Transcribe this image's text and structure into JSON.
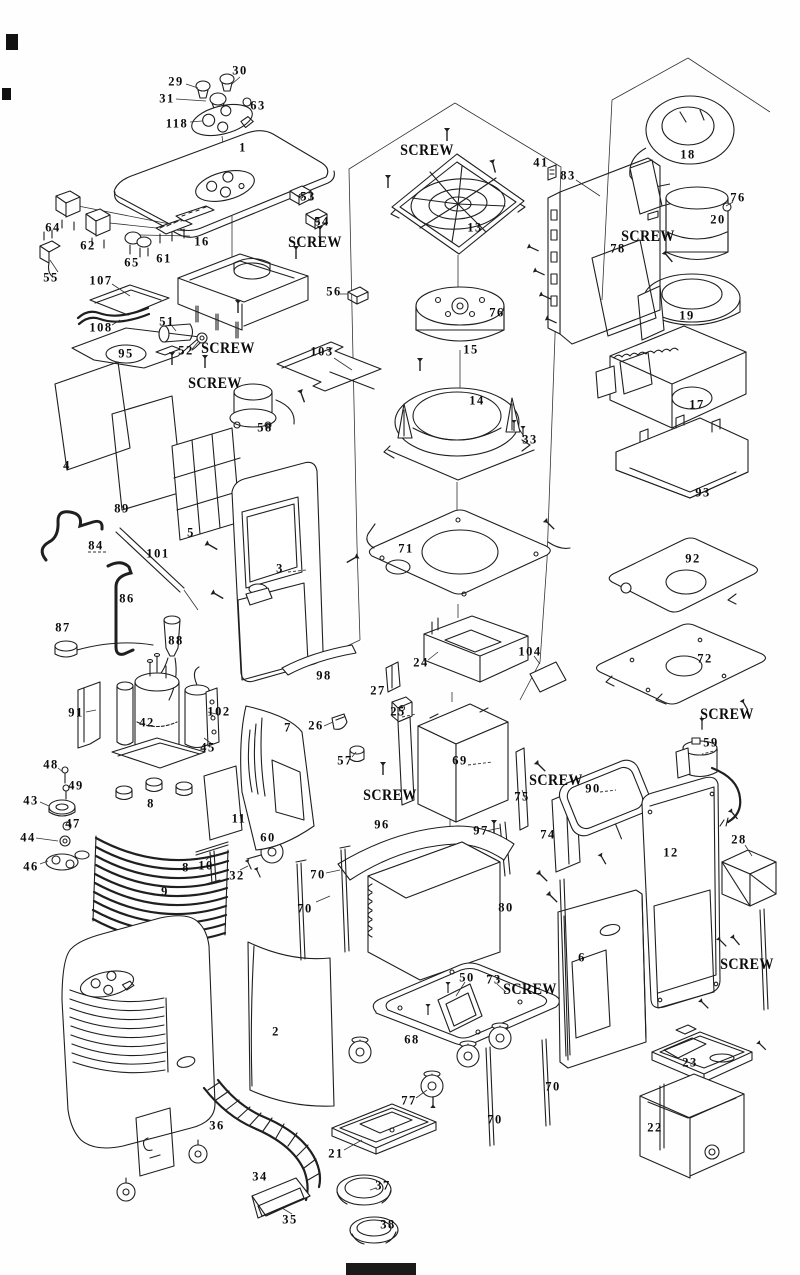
{
  "diagram": {
    "type": "exploded-parts-diagram",
    "subject": "portable air conditioner exploded parts view",
    "background_color": "#fefefe",
    "line_color": "#1f1f1f",
    "label_color": "#0d0d0d",
    "screw_text": "SCREW",
    "part_labels": [
      {
        "text": "29",
        "x": 176,
        "y": 82
      },
      {
        "text": "30",
        "x": 240,
        "y": 71
      },
      {
        "text": "31",
        "x": 167,
        "y": 99
      },
      {
        "text": "63",
        "x": 258,
        "y": 106
      },
      {
        "text": "118",
        "x": 177,
        "y": 124
      },
      {
        "text": "1",
        "x": 243,
        "y": 148
      },
      {
        "text": "53",
        "x": 308,
        "y": 197
      },
      {
        "text": "54",
        "x": 322,
        "y": 222
      },
      {
        "text": "64",
        "x": 53,
        "y": 228
      },
      {
        "text": "62",
        "x": 88,
        "y": 246
      },
      {
        "text": "65",
        "x": 132,
        "y": 263
      },
      {
        "text": "61",
        "x": 164,
        "y": 259
      },
      {
        "text": "16",
        "x": 202,
        "y": 242
      },
      {
        "text": "55",
        "x": 51,
        "y": 278
      },
      {
        "text": "107",
        "x": 101,
        "y": 281
      },
      {
        "text": "108",
        "x": 101,
        "y": 328
      },
      {
        "text": "51",
        "x": 167,
        "y": 322
      },
      {
        "text": "52",
        "x": 186,
        "y": 351
      },
      {
        "text": "95",
        "x": 126,
        "y": 354
      },
      {
        "text": "56",
        "x": 334,
        "y": 292
      },
      {
        "text": "103",
        "x": 322,
        "y": 352
      },
      {
        "text": "58",
        "x": 265,
        "y": 428
      },
      {
        "text": "4",
        "x": 67,
        "y": 466
      },
      {
        "text": "89",
        "x": 122,
        "y": 509
      },
      {
        "text": "5",
        "x": 191,
        "y": 533
      },
      {
        "text": "84",
        "x": 96,
        "y": 546
      },
      {
        "text": "101",
        "x": 158,
        "y": 554
      },
      {
        "text": "86",
        "x": 127,
        "y": 599
      },
      {
        "text": "87",
        "x": 63,
        "y": 628
      },
      {
        "text": "88",
        "x": 176,
        "y": 641
      },
      {
        "text": "3",
        "x": 280,
        "y": 569
      },
      {
        "text": "98",
        "x": 324,
        "y": 676
      },
      {
        "text": "13",
        "x": 475,
        "y": 228
      },
      {
        "text": "41",
        "x": 541,
        "y": 163
      },
      {
        "text": "83",
        "x": 568,
        "y": 176
      },
      {
        "text": "76",
        "x": 497,
        "y": 313
      },
      {
        "text": "15",
        "x": 471,
        "y": 350
      },
      {
        "text": "14",
        "x": 477,
        "y": 401
      },
      {
        "text": "33",
        "x": 530,
        "y": 440
      },
      {
        "text": "18",
        "x": 688,
        "y": 155
      },
      {
        "text": "76",
        "x": 738,
        "y": 198
      },
      {
        "text": "20",
        "x": 718,
        "y": 220
      },
      {
        "text": "78",
        "x": 618,
        "y": 249
      },
      {
        "text": "19",
        "x": 687,
        "y": 316
      },
      {
        "text": "17",
        "x": 697,
        "y": 405
      },
      {
        "text": "93",
        "x": 703,
        "y": 493
      },
      {
        "text": "92",
        "x": 693,
        "y": 559
      },
      {
        "text": "72",
        "x": 705,
        "y": 659
      },
      {
        "text": "71",
        "x": 406,
        "y": 549
      },
      {
        "text": "24",
        "x": 421,
        "y": 663
      },
      {
        "text": "104",
        "x": 530,
        "y": 652
      },
      {
        "text": "27",
        "x": 378,
        "y": 691
      },
      {
        "text": "25",
        "x": 398,
        "y": 712
      },
      {
        "text": "26",
        "x": 316,
        "y": 726
      },
      {
        "text": "57",
        "x": 345,
        "y": 761
      },
      {
        "text": "69",
        "x": 460,
        "y": 761
      },
      {
        "text": "75",
        "x": 522,
        "y": 797
      },
      {
        "text": "96",
        "x": 382,
        "y": 825
      },
      {
        "text": "97",
        "x": 481,
        "y": 831
      },
      {
        "text": "74",
        "x": 548,
        "y": 835
      },
      {
        "text": "91",
        "x": 76,
        "y": 713
      },
      {
        "text": "42",
        "x": 147,
        "y": 723
      },
      {
        "text": "102",
        "x": 219,
        "y": 712
      },
      {
        "text": "45",
        "x": 208,
        "y": 748
      },
      {
        "text": "7",
        "x": 288,
        "y": 728
      },
      {
        "text": "48",
        "x": 51,
        "y": 765
      },
      {
        "text": "49",
        "x": 76,
        "y": 786
      },
      {
        "text": "43",
        "x": 31,
        "y": 801
      },
      {
        "text": "47",
        "x": 73,
        "y": 824
      },
      {
        "text": "44",
        "x": 28,
        "y": 838
      },
      {
        "text": "46",
        "x": 31,
        "y": 867
      },
      {
        "text": "8",
        "x": 151,
        "y": 804
      },
      {
        "text": "11",
        "x": 239,
        "y": 819
      },
      {
        "text": "60",
        "x": 268,
        "y": 838
      },
      {
        "text": "10",
        "x": 206,
        "y": 866
      },
      {
        "text": "32",
        "x": 237,
        "y": 876
      },
      {
        "text": "9",
        "x": 165,
        "y": 892
      },
      {
        "text": "8",
        "x": 186,
        "y": 868
      },
      {
        "text": "59",
        "x": 711,
        "y": 743
      },
      {
        "text": "90",
        "x": 593,
        "y": 789
      },
      {
        "text": "12",
        "x": 671,
        "y": 853
      },
      {
        "text": "28",
        "x": 739,
        "y": 840
      },
      {
        "text": "70",
        "x": 318,
        "y": 875
      },
      {
        "text": "70",
        "x": 305,
        "y": 909
      },
      {
        "text": "80",
        "x": 506,
        "y": 908
      },
      {
        "text": "2",
        "x": 276,
        "y": 1032
      },
      {
        "text": "50",
        "x": 467,
        "y": 978
      },
      {
        "text": "73",
        "x": 494,
        "y": 980
      },
      {
        "text": "68",
        "x": 412,
        "y": 1040
      },
      {
        "text": "6",
        "x": 582,
        "y": 958
      },
      {
        "text": "23",
        "x": 690,
        "y": 1063
      },
      {
        "text": "22",
        "x": 655,
        "y": 1128
      },
      {
        "text": "70",
        "x": 553,
        "y": 1087
      },
      {
        "text": "70",
        "x": 495,
        "y": 1120
      },
      {
        "text": "36",
        "x": 217,
        "y": 1126
      },
      {
        "text": "34",
        "x": 260,
        "y": 1177
      },
      {
        "text": "77",
        "x": 409,
        "y": 1101
      },
      {
        "text": "21",
        "x": 336,
        "y": 1154
      },
      {
        "text": "35",
        "x": 290,
        "y": 1220
      },
      {
        "text": "37",
        "x": 383,
        "y": 1186
      },
      {
        "text": "38",
        "x": 388,
        "y": 1225
      }
    ],
    "screw_labels": [
      {
        "x": 427,
        "y": 151
      },
      {
        "x": 315,
        "y": 243
      },
      {
        "x": 648,
        "y": 237
      },
      {
        "x": 228,
        "y": 349
      },
      {
        "x": 215,
        "y": 384
      },
      {
        "x": 390,
        "y": 796
      },
      {
        "x": 556,
        "y": 781
      },
      {
        "x": 727,
        "y": 715
      },
      {
        "x": 747,
        "y": 965
      },
      {
        "x": 530,
        "y": 990
      }
    ]
  }
}
